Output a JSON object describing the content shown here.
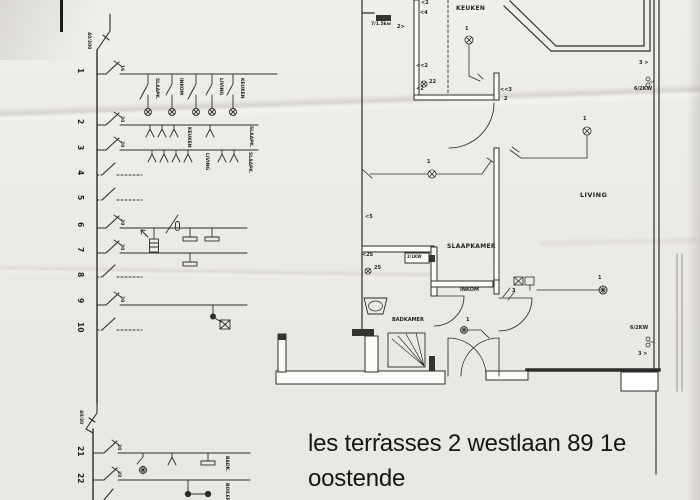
{
  "address": {
    "line1": "les terrasses 2 westlaan 89 1e",
    "line2": "oostende"
  },
  "schematic": {
    "main_rcd": "40/300",
    "sub_rcd": "40/30",
    "row_numbers": [
      "1",
      "2",
      "3",
      "4",
      "5",
      "6",
      "7",
      "8",
      "9",
      "10",
      "21",
      "22"
    ],
    "breaker_ratings": {
      "r1": "16",
      "r2": "20",
      "r3": "20",
      "r6": "20",
      "r7": "20",
      "r9": "20",
      "r21": "20",
      "r22": "20"
    },
    "circuit1_branches": [
      "SLAAPK.",
      "INKOM",
      "LIVING",
      "KEUKEN"
    ],
    "circuit2_groups": [
      "KEUKEN",
      "SLAAPK."
    ],
    "circuit3_groups": [
      "LIVING",
      "SLAAPK."
    ],
    "circuit21_label": "BADK.",
    "circuit22_label": "BOILER"
  },
  "floorplan": {
    "rooms": {
      "kitchen": "KEUKEN",
      "living": "LIVING",
      "bedroom": "SLAAPKAMER",
      "hall": "INKOM",
      "bathroom": "BADKAMER"
    },
    "power_labels": {
      "hood": "7/1.5kw",
      "bedroom_heater": "2/1KW",
      "living_heater_top": "6/2KW",
      "living_heater_bottom": "6/2KW"
    },
    "light_ids": {
      "kitchen": "1",
      "living_top": "1",
      "living_bottom": "1",
      "bedroom": "1",
      "hall": "1"
    },
    "annotations": {
      "k_socket_a": "<2",
      "k_socket_b": "<4",
      "k_switch": "2>",
      "k_socket_c": "<<2",
      "k_spot": "22",
      "k_socket_d": "<2",
      "hall_socket": "<<3",
      "hall_socket_n": "2",
      "bed_socket": "<5",
      "bath_socket": "<25",
      "bath_spot": "25",
      "sw_living_top": "3 >",
      "sw_living_bottom": "3 >",
      "sw_hall": "3"
    }
  }
}
